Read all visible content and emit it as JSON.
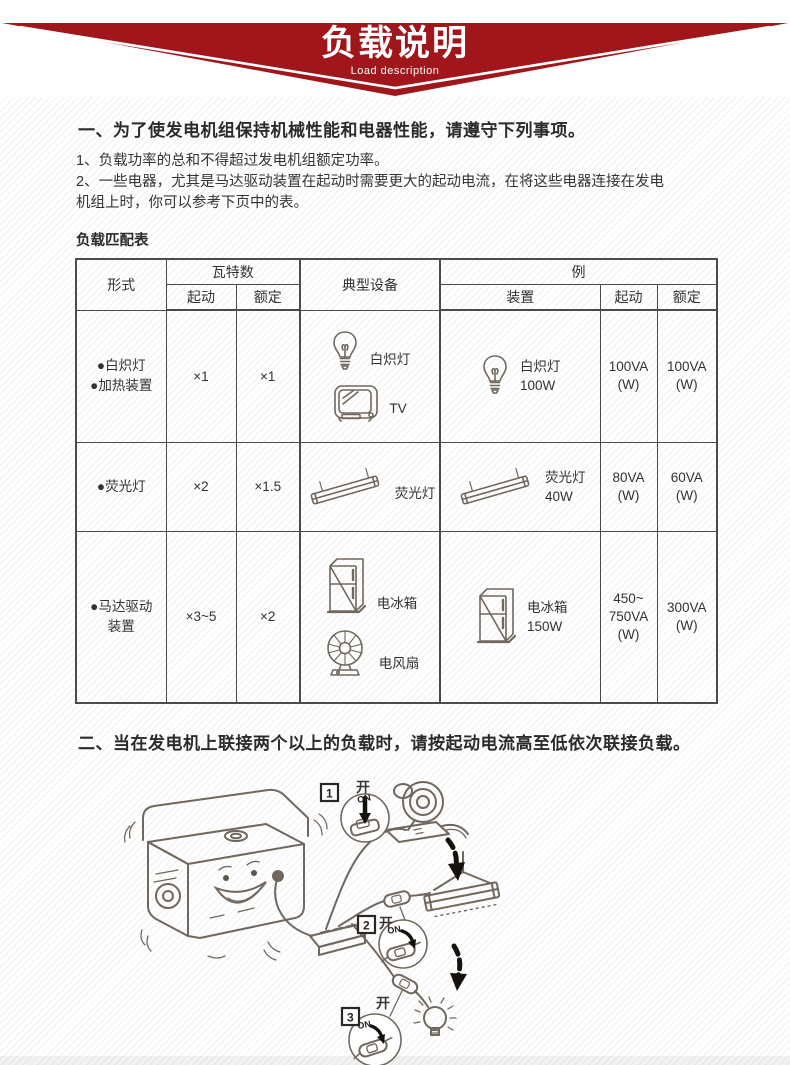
{
  "banner": {
    "title": "负载说明",
    "subtitle": "Load description",
    "accent_color": "#a1161b"
  },
  "section1": {
    "heading": "一、为了使发电机组保持机械性能和电器性能，请遵守下列事项。",
    "items": [
      "1、负载功率的总和不得超过发电机组额定功率。",
      "2、一些电器，尤其是马达驱动装置在起动时需要更大的起动电流，在将这些电器连接在发电机组上时，你可以参考下页中的表。"
    ],
    "table_label": "负载匹配表"
  },
  "load_table": {
    "headers": {
      "type": "形式",
      "wattage_group": "瓦特数",
      "start": "起动",
      "rated": "额定",
      "typical": "典型设备",
      "example_group": "例",
      "device": "装置",
      "ex_start": "起动",
      "ex_rated": "额定"
    },
    "rows": [
      {
        "type_lines": [
          "●白炽灯",
          "●加热装置"
        ],
        "start_factor": "×1",
        "rated_factor": "×1",
        "typical": [
          {
            "icon": "bulb-icon",
            "label": "白炽灯"
          },
          {
            "icon": "tv-icon",
            "label": "TV"
          }
        ],
        "example_device": {
          "icon": "bulb-icon",
          "lines": [
            "白炽灯",
            "100W"
          ]
        },
        "example_start": [
          "100VA",
          "(W)"
        ],
        "example_rated": [
          "100VA",
          "(W)"
        ]
      },
      {
        "type_lines": [
          "●荧光灯"
        ],
        "start_factor": "×2",
        "rated_factor": "×1.5",
        "typical": [
          {
            "icon": "fluorescent-icon",
            "label": "荧光灯"
          }
        ],
        "example_device": {
          "icon": "fluorescent-icon",
          "lines": [
            "荧光灯",
            "40W"
          ]
        },
        "example_start": [
          "80VA",
          "(W)"
        ],
        "example_rated": [
          "60VA",
          "(W)"
        ]
      },
      {
        "type_lines": [
          "●马达驱动",
          "装置"
        ],
        "start_factor": "×3~5",
        "rated_factor": "×2",
        "typical": [
          {
            "icon": "fridge-icon",
            "label": "电冰箱"
          },
          {
            "icon": "fan-icon",
            "label": "电风扇"
          }
        ],
        "example_device": {
          "icon": "fridge-icon",
          "lines": [
            "电冰箱",
            "150W"
          ]
        },
        "example_start": [
          "450~",
          "750VA",
          "(W)"
        ],
        "example_rated": [
          "300VA",
          "(W)"
        ]
      }
    ]
  },
  "section2": {
    "heading": "二、当在发电机上联接两个以上的负载时，请按起动电流高至低依次联接负载。"
  },
  "illustration": {
    "steps": [
      {
        "number": "1",
        "switch_label": "开",
        "switch_state": "ON"
      },
      {
        "number": "2",
        "switch_label": "开",
        "switch_state": "ON"
      },
      {
        "number": "3",
        "switch_label": "开",
        "switch_state": "ON"
      }
    ]
  }
}
